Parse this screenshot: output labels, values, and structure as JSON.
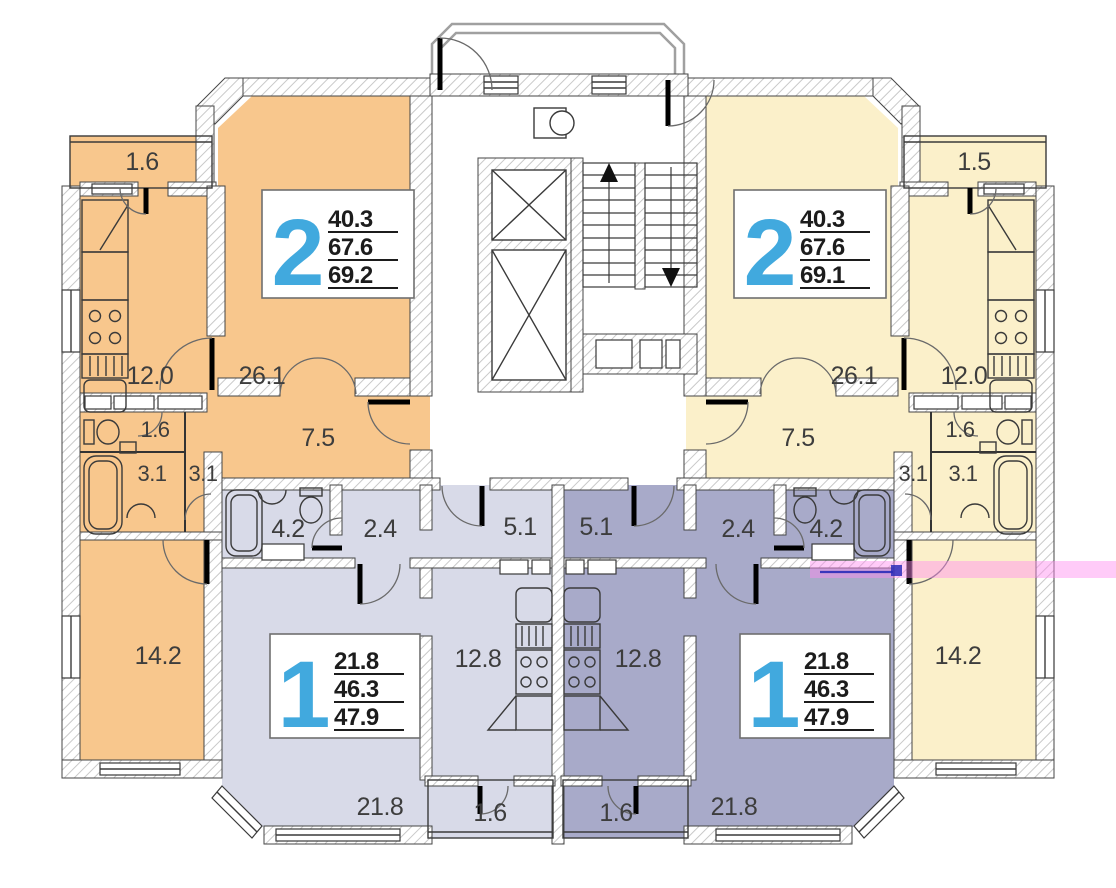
{
  "title": "apartment-building-floor-plan",
  "colors": {
    "apt2_left": "#F8C78D",
    "apt2_right": "#FBF0CA",
    "apt1_left": "#D8DAE8",
    "apt1_right": "#A8AAC9",
    "number_blue": "#41A9DE",
    "label_gray": "#3D3D3D",
    "highlight_pink": "#FF8CF0",
    "highlight_navy": "#2B2BB8"
  },
  "apartments": [
    {
      "id": "2-room-left",
      "type_number": "2",
      "area_lines": [
        "40.3",
        "67.6",
        "69.2"
      ],
      "rooms": {
        "balcony": "1.6",
        "kitchen": "12.0",
        "living": "26.1",
        "hall": "7.5",
        "wc": "1.6",
        "bath": "3.1",
        "hall2": "3.1",
        "bedroom": "14.2"
      }
    },
    {
      "id": "2-room-right",
      "type_number": "2",
      "area_lines": [
        "40.3",
        "67.6",
        "69.1"
      ],
      "rooms": {
        "balcony": "1.5",
        "kitchen": "12.0",
        "living": "26.1",
        "hall": "7.5",
        "wc": "1.6",
        "bath": "3.1",
        "hall2": "3.1",
        "bedroom": "14.2"
      }
    },
    {
      "id": "1-room-left",
      "type_number": "1",
      "area_lines": [
        "21.8",
        "46.3",
        "47.9"
      ],
      "rooms": {
        "bath": "4.2",
        "hall": "2.4",
        "entry": "5.1",
        "kitchen": "12.8",
        "living": "21.8",
        "balcony": "1.6"
      }
    },
    {
      "id": "1-room-right",
      "type_number": "1",
      "area_lines": [
        "21.8",
        "46.3",
        "47.9"
      ],
      "rooms": {
        "entry": "5.1",
        "hall": "2.4",
        "bath": "4.2",
        "kitchen": "12.8",
        "living": "21.8",
        "balcony": "1.6"
      }
    }
  ]
}
